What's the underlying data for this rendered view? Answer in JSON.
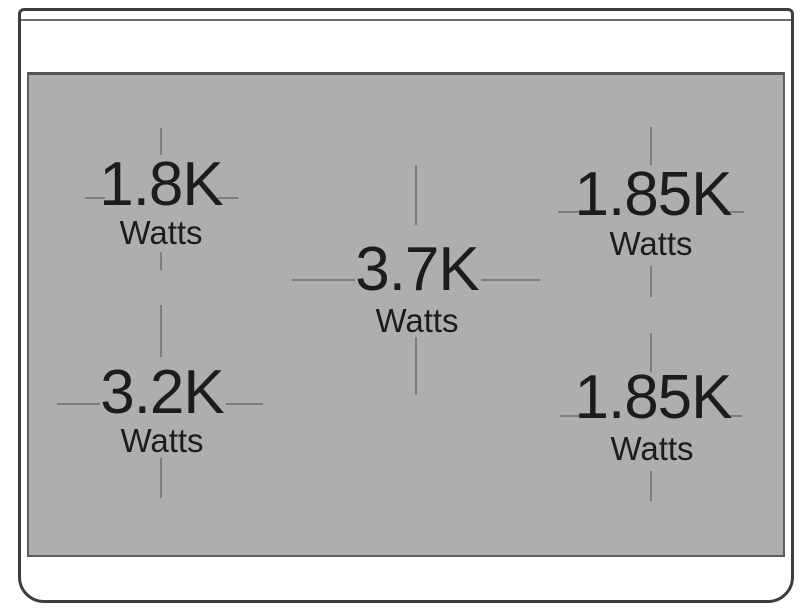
{
  "colors": {
    "background": "#ffffff",
    "cooktop_surface": "#aeaeae",
    "crosshair_line": "#7d7d7d",
    "body_outline": "#3d3d3d",
    "trim_line": "#6e6e6e",
    "label_text": "#1c1c1c"
  },
  "burners": [
    {
      "position": "top-left",
      "power": "1.8K",
      "unit": "Watts"
    },
    {
      "position": "top-right",
      "power": "1.85K",
      "unit": "Watts"
    },
    {
      "position": "center",
      "power": "3.7K",
      "unit": "Watts"
    },
    {
      "position": "bottom-left",
      "power": "3.2K",
      "unit": "Watts"
    },
    {
      "position": "bottom-right",
      "power": "1.85K",
      "unit": "Watts"
    }
  ]
}
